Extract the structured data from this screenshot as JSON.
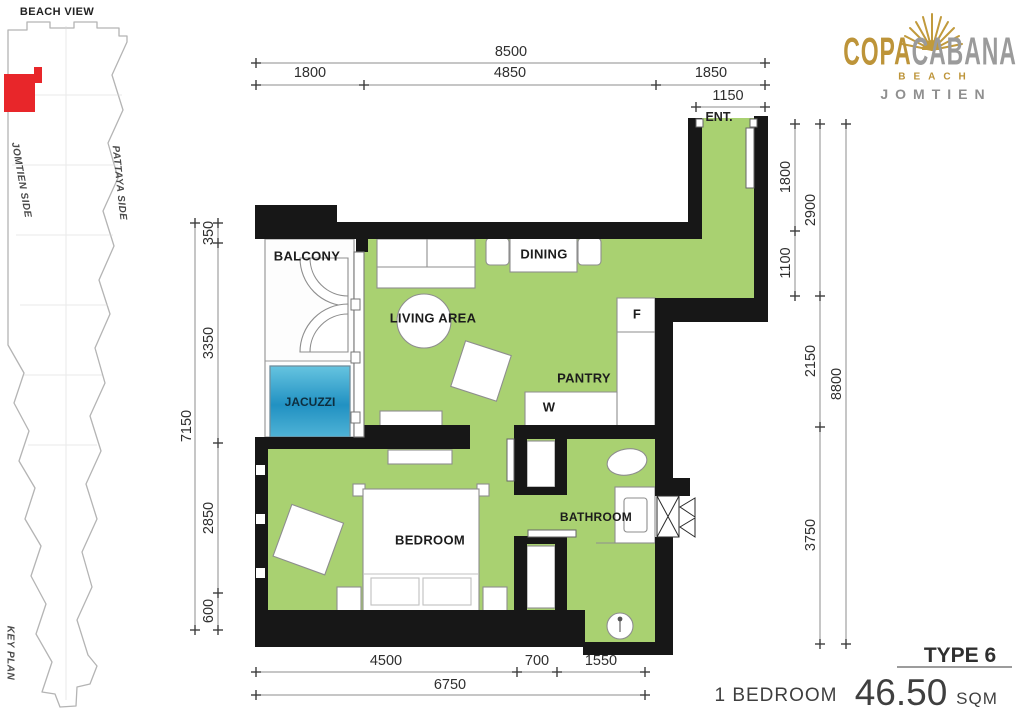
{
  "logo": {
    "brand_gold": "COPA",
    "brand_gray": "CABANA",
    "beach": "BEACH",
    "city": "JOMTIEN"
  },
  "keyplan": {
    "beach_view": "BEACH VIEW",
    "jomtien_side": "JOMTIEN SIDE",
    "pattaya_side": "PATTAYA SIDE",
    "label": "KEY PLAN"
  },
  "rooms": {
    "balcony": "BALCONY",
    "jacuzzi": "JACUZZI",
    "living": "LIVING AREA",
    "dining": "DINING",
    "pantry": "PANTRY",
    "fridge": "F",
    "washer": "W",
    "bedroom": "BEDROOM",
    "bathroom": "BATHROOM",
    "entrance": "ENT."
  },
  "dims": {
    "top_total": "8500",
    "top_a": "1800",
    "top_b": "4850",
    "top_c": "1850",
    "entry": "1150",
    "left_total": "7150",
    "left_a": "350",
    "left_b": "3350",
    "left_c": "2850",
    "left_d": "600",
    "right_a": "1800",
    "right_b": "1100",
    "right_c": "2900",
    "right_d": "2150",
    "right_e": "3750",
    "right_total": "8800",
    "bottom_a": "4500",
    "bottom_b": "700",
    "bottom_c": "1550",
    "bottom_total": "6750"
  },
  "summary": {
    "type": "TYPE 6",
    "bedrooms": "1 BEDROOM",
    "area": "46.50",
    "unit": "SQM"
  },
  "colors": {
    "floor_green": "#a9d171",
    "wall_black": "#171717",
    "jacuzzi_blue": "#2191c2",
    "logo_gold": "#bd9439",
    "logo_gray": "#9b9b9b",
    "highlight_red": "#e8262a"
  }
}
